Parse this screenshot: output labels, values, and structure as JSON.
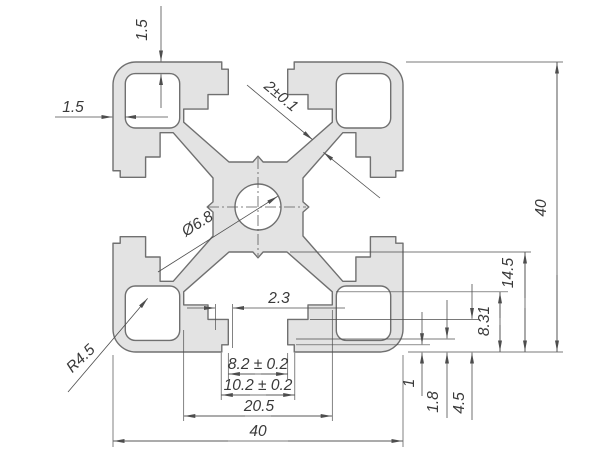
{
  "meta": {
    "type": "technical-drawing",
    "subject": "40x40 aluminium T-slot extrusion profile cross-section"
  },
  "colors": {
    "background": "#ffffff",
    "part_fill": "#e3e3e3",
    "part_outline": "#707070",
    "dimension_lines": "#4d4d4d",
    "text": "#3a3a3a"
  },
  "labels": {
    "wall_top": "1.5",
    "wall_left": "1.5",
    "web_thickness": "2±0.1",
    "overall_height": "40",
    "center_hole": "Ø6.8",
    "corner_radius": "R4.5",
    "lip_thickness": "2.3",
    "slot_depth": "14.5",
    "undercut_height": "8.31",
    "slot_opening": "8.2 ± 0.2",
    "slot_under_lip": "10.2 ± 0.2",
    "slot_cavity_width": "20.5",
    "step_one": "1",
    "step_one_eight": "1.8",
    "step_four_five": "4.5",
    "overall_width": "40"
  }
}
